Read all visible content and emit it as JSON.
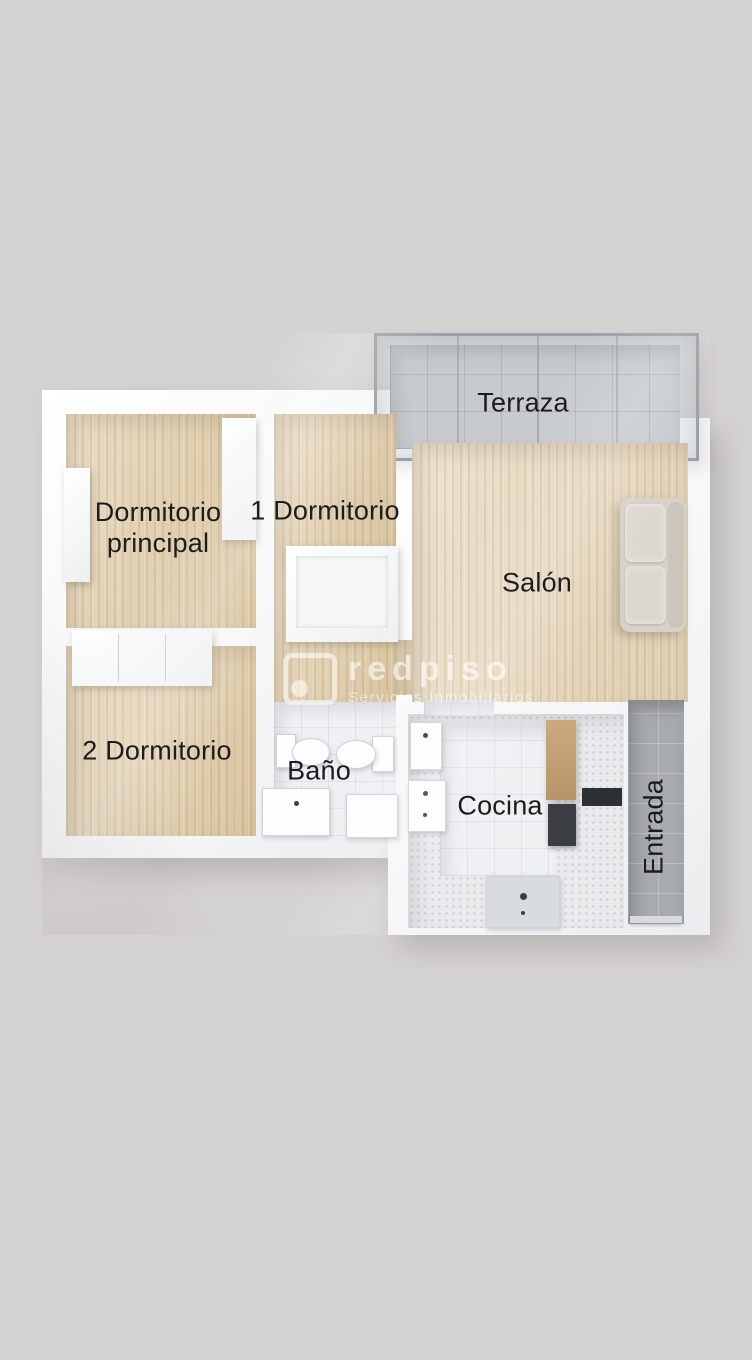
{
  "floorplan": {
    "type": "3d-top-down-apartment-render",
    "rooms": [
      {
        "id": "terraza",
        "label": "Terraza"
      },
      {
        "id": "dormitorio-principal",
        "label": "Dormitorio\nprincipal"
      },
      {
        "id": "dormitorio-1",
        "label": "1 Dormitorio"
      },
      {
        "id": "salon",
        "label": "Salón"
      },
      {
        "id": "dormitorio-2",
        "label": "2 Dormitorio"
      },
      {
        "id": "bano",
        "label": "Baño"
      },
      {
        "id": "cocina",
        "label": "Cocina"
      },
      {
        "id": "entrada",
        "label": "Entrada"
      }
    ],
    "colors": {
      "background": "#d5d3d2",
      "wall": "#ffffff",
      "wood_floor": "#e1cda9",
      "white_tile": "#eef0f2",
      "gray_tile": "#a7aaae",
      "terrace_tile": "#c7cacd",
      "label_text": "#1c1c1e",
      "sofa": "#d7d1c8"
    }
  },
  "watermark": {
    "brand": "redpiso",
    "tagline": "Servicios Inmobiliarios"
  }
}
